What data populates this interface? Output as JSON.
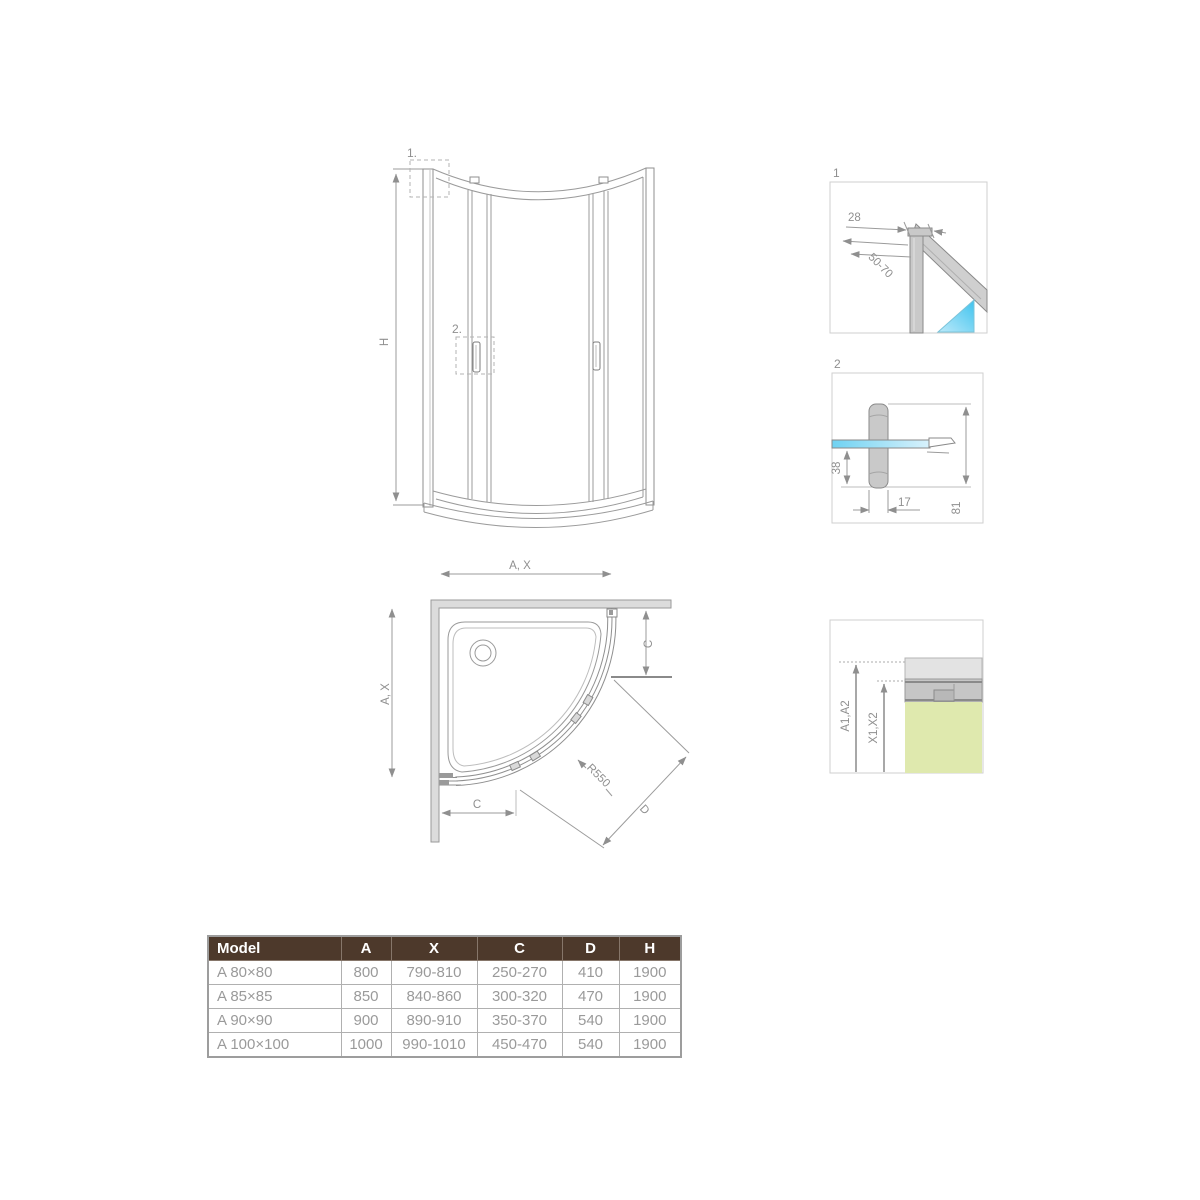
{
  "front_view": {
    "detail_1_marker": "1.",
    "detail_2_marker": "2.",
    "height_dim": "H"
  },
  "detail_box_1": {
    "label": "1",
    "width_dim": "28",
    "range_dim": "50-70"
  },
  "detail_box_2": {
    "label": "2",
    "glass_offset_dim": "38",
    "handle_width_dim": "17",
    "handle_height_dim": "81"
  },
  "plan_view": {
    "width_dim": "A, X",
    "depth_dim": "A, X",
    "side_dim_right": "C",
    "side_dim_bottom": "C",
    "radius_dim": "R550",
    "entry_dim": "D"
  },
  "detail_box_3": {
    "outer_dim": "A1,A2",
    "inner_dim": "X1,X2"
  },
  "table": {
    "headers": [
      "Model",
      "A",
      "X",
      "C",
      "D",
      "H"
    ],
    "rows": [
      [
        "A 80×80",
        "800",
        "790-810",
        "250-270",
        "410",
        "1900"
      ],
      [
        "A 85×85",
        "850",
        "840-860",
        "300-320",
        "470",
        "1900"
      ],
      [
        "A 90×90",
        "900",
        "890-910",
        "350-370",
        "540",
        "1900"
      ],
      [
        "A 100×100",
        "1000",
        "990-1010",
        "450-470",
        "540",
        "1900"
      ]
    ]
  },
  "colors": {
    "header_bg": "#4d392b",
    "header_text": "#ffffff",
    "row_text": "#9a9a9a",
    "line_gray": "#8f8f8f",
    "wall_gray": "#dcdcdc",
    "profile_gray": "#c9c9c9",
    "glass_blue": "#4fc7ef",
    "glass_green": "#dfe9ae"
  }
}
